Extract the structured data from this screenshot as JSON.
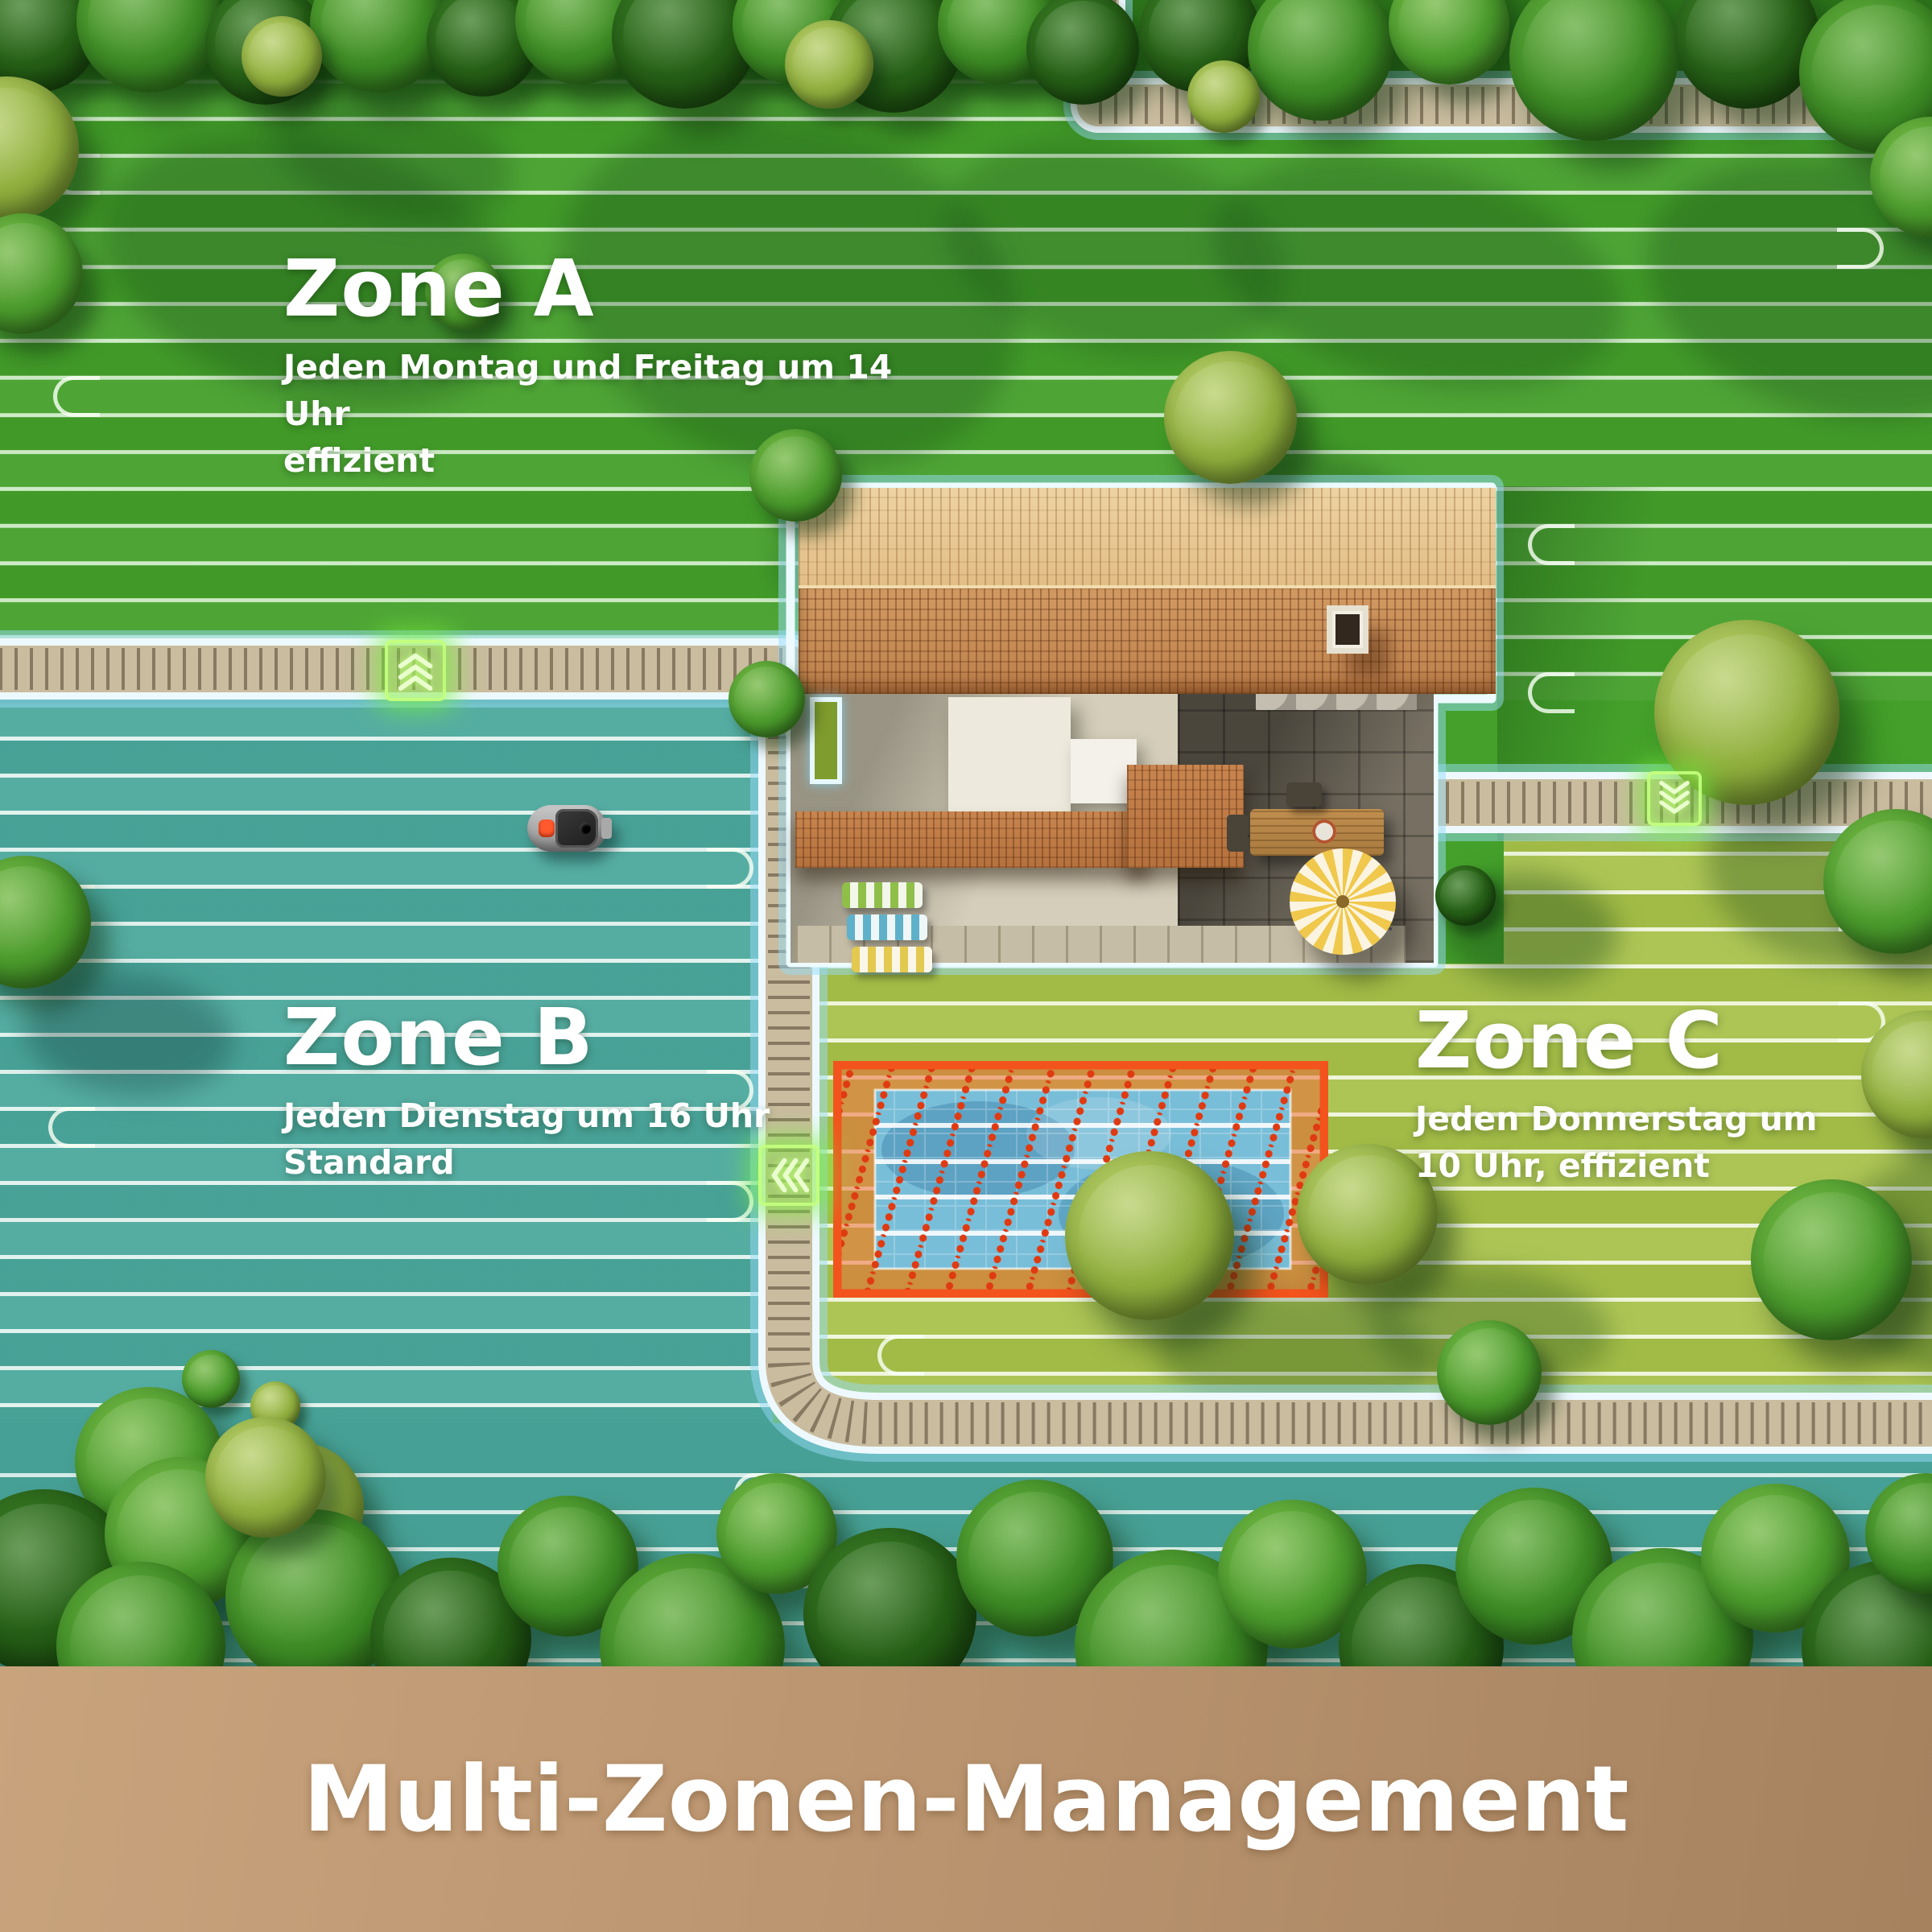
{
  "zones": [
    {
      "name": "Zone A",
      "schedule": "Jeden Montag und Freitag um 14 Uhr",
      "mode": "effizient",
      "lawn_color": "#44a02a"
    },
    {
      "name": "Zone B",
      "schedule": "Jeden Dienstag um 16 Uhr",
      "mode": "Standard",
      "lawn_color": "#4ca99d"
    },
    {
      "name": "Zone C",
      "schedule": "Jeden Donnerstag um",
      "mode": "10 Uhr, effizient",
      "lawn_color": "#a8c14a"
    }
  ],
  "banner": {
    "title": "Multi-Zonen-Management",
    "background": "#bb9570",
    "text_color": "#ffffff"
  },
  "no_go_zone": {
    "area": "pool",
    "border_color": "#f3531d",
    "fill_color": "rgba(238,108,58,0.55)",
    "hatch_color": "#e03a12"
  },
  "transfer_markers": [
    {
      "id": "zone-a-to-zone-b",
      "direction": "up",
      "color": "#8df23e"
    },
    {
      "id": "zone-a-to-zone-c",
      "direction": "down",
      "color": "#8df23e"
    },
    {
      "id": "zone-c-to-zone-b",
      "direction": "left",
      "color": "#8df23e"
    }
  ],
  "mower": {
    "location_zone": "Zone B",
    "button_color": "#ff5a2e"
  },
  "palette": {
    "boundary_glow": "#bfe9f8",
    "walkway": "#c9bc9f",
    "mow_line": "#f4fff2"
  }
}
